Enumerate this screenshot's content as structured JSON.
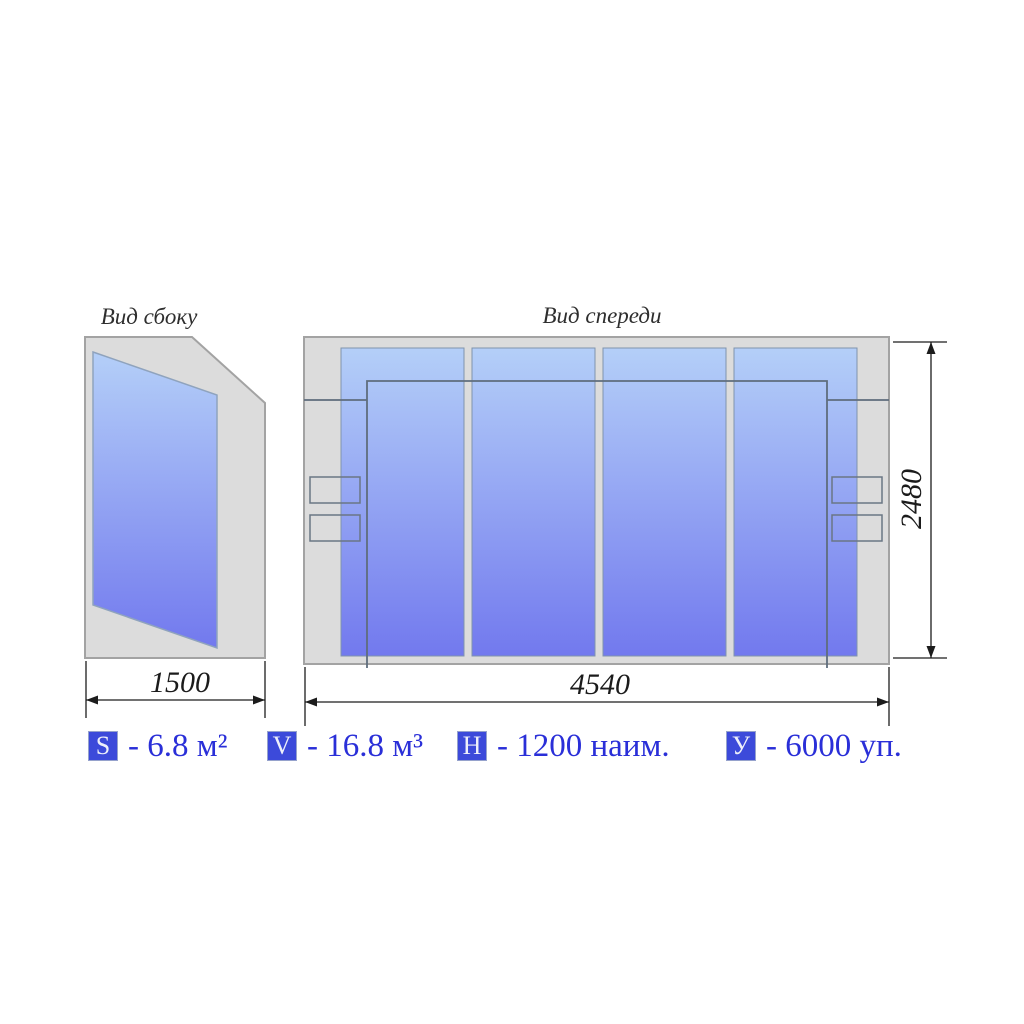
{
  "titles": {
    "side_view": "Вид сбоку",
    "front_view": "Вид спереди"
  },
  "dimensions": {
    "side_width": "1500",
    "front_width": "4540",
    "height": "2480"
  },
  "legend": {
    "items": [
      {
        "symbol": "S",
        "value": "- 6.8 м²"
      },
      {
        "symbol": "V",
        "value": "- 16.8 м³"
      },
      {
        "symbol": "Н",
        "value": "- 1200 наим."
      },
      {
        "symbol": "У",
        "value": "- 6000 уп."
      }
    ]
  },
  "colors": {
    "accent_text_blue": "#2a2fd8",
    "badge_blue": "#3c4ada",
    "glass_top": "#b4cff8",
    "glass_bottom": "#7279ee",
    "frame_gray": "#dcdcdc",
    "frame_border": "#a3a3a3",
    "linework_dark": "#5f6d7d",
    "dimension_line": "#1c1c1c"
  }
}
